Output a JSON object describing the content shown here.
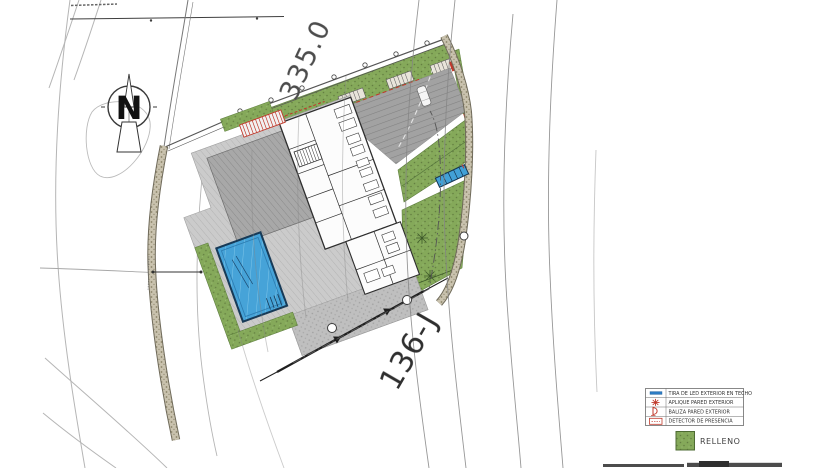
{
  "sheet": {
    "type": "architectural-site-plan",
    "north_label": "N",
    "elevation_label": "335.0",
    "parcel_label": "136-J"
  },
  "legend": {
    "items": [
      {
        "icon": "led-strip-icon",
        "label": "TIRA DE LED EXTERIOR EN TECHO"
      },
      {
        "icon": "wall-sconce-icon",
        "label": "APLIQUE PARED EXTERIOR"
      },
      {
        "icon": "wall-beacon-icon",
        "label": "BALIZA PARED EXTERIOR"
      },
      {
        "icon": "presence-detector-icon",
        "label": "DETECTOR DE PRESENCIA"
      }
    ],
    "fill": {
      "label": "RELLENO"
    }
  },
  "colors": {
    "landscape_green": "#85a95a",
    "pool_blue": "#46a3d8",
    "accent_red": "#c0392b",
    "led_blue": "#2e7cc3",
    "paving_gray": "#cbcbcb",
    "driveway_gray": "#a2a2a2",
    "boundary_wall": "#c9c2ae"
  }
}
